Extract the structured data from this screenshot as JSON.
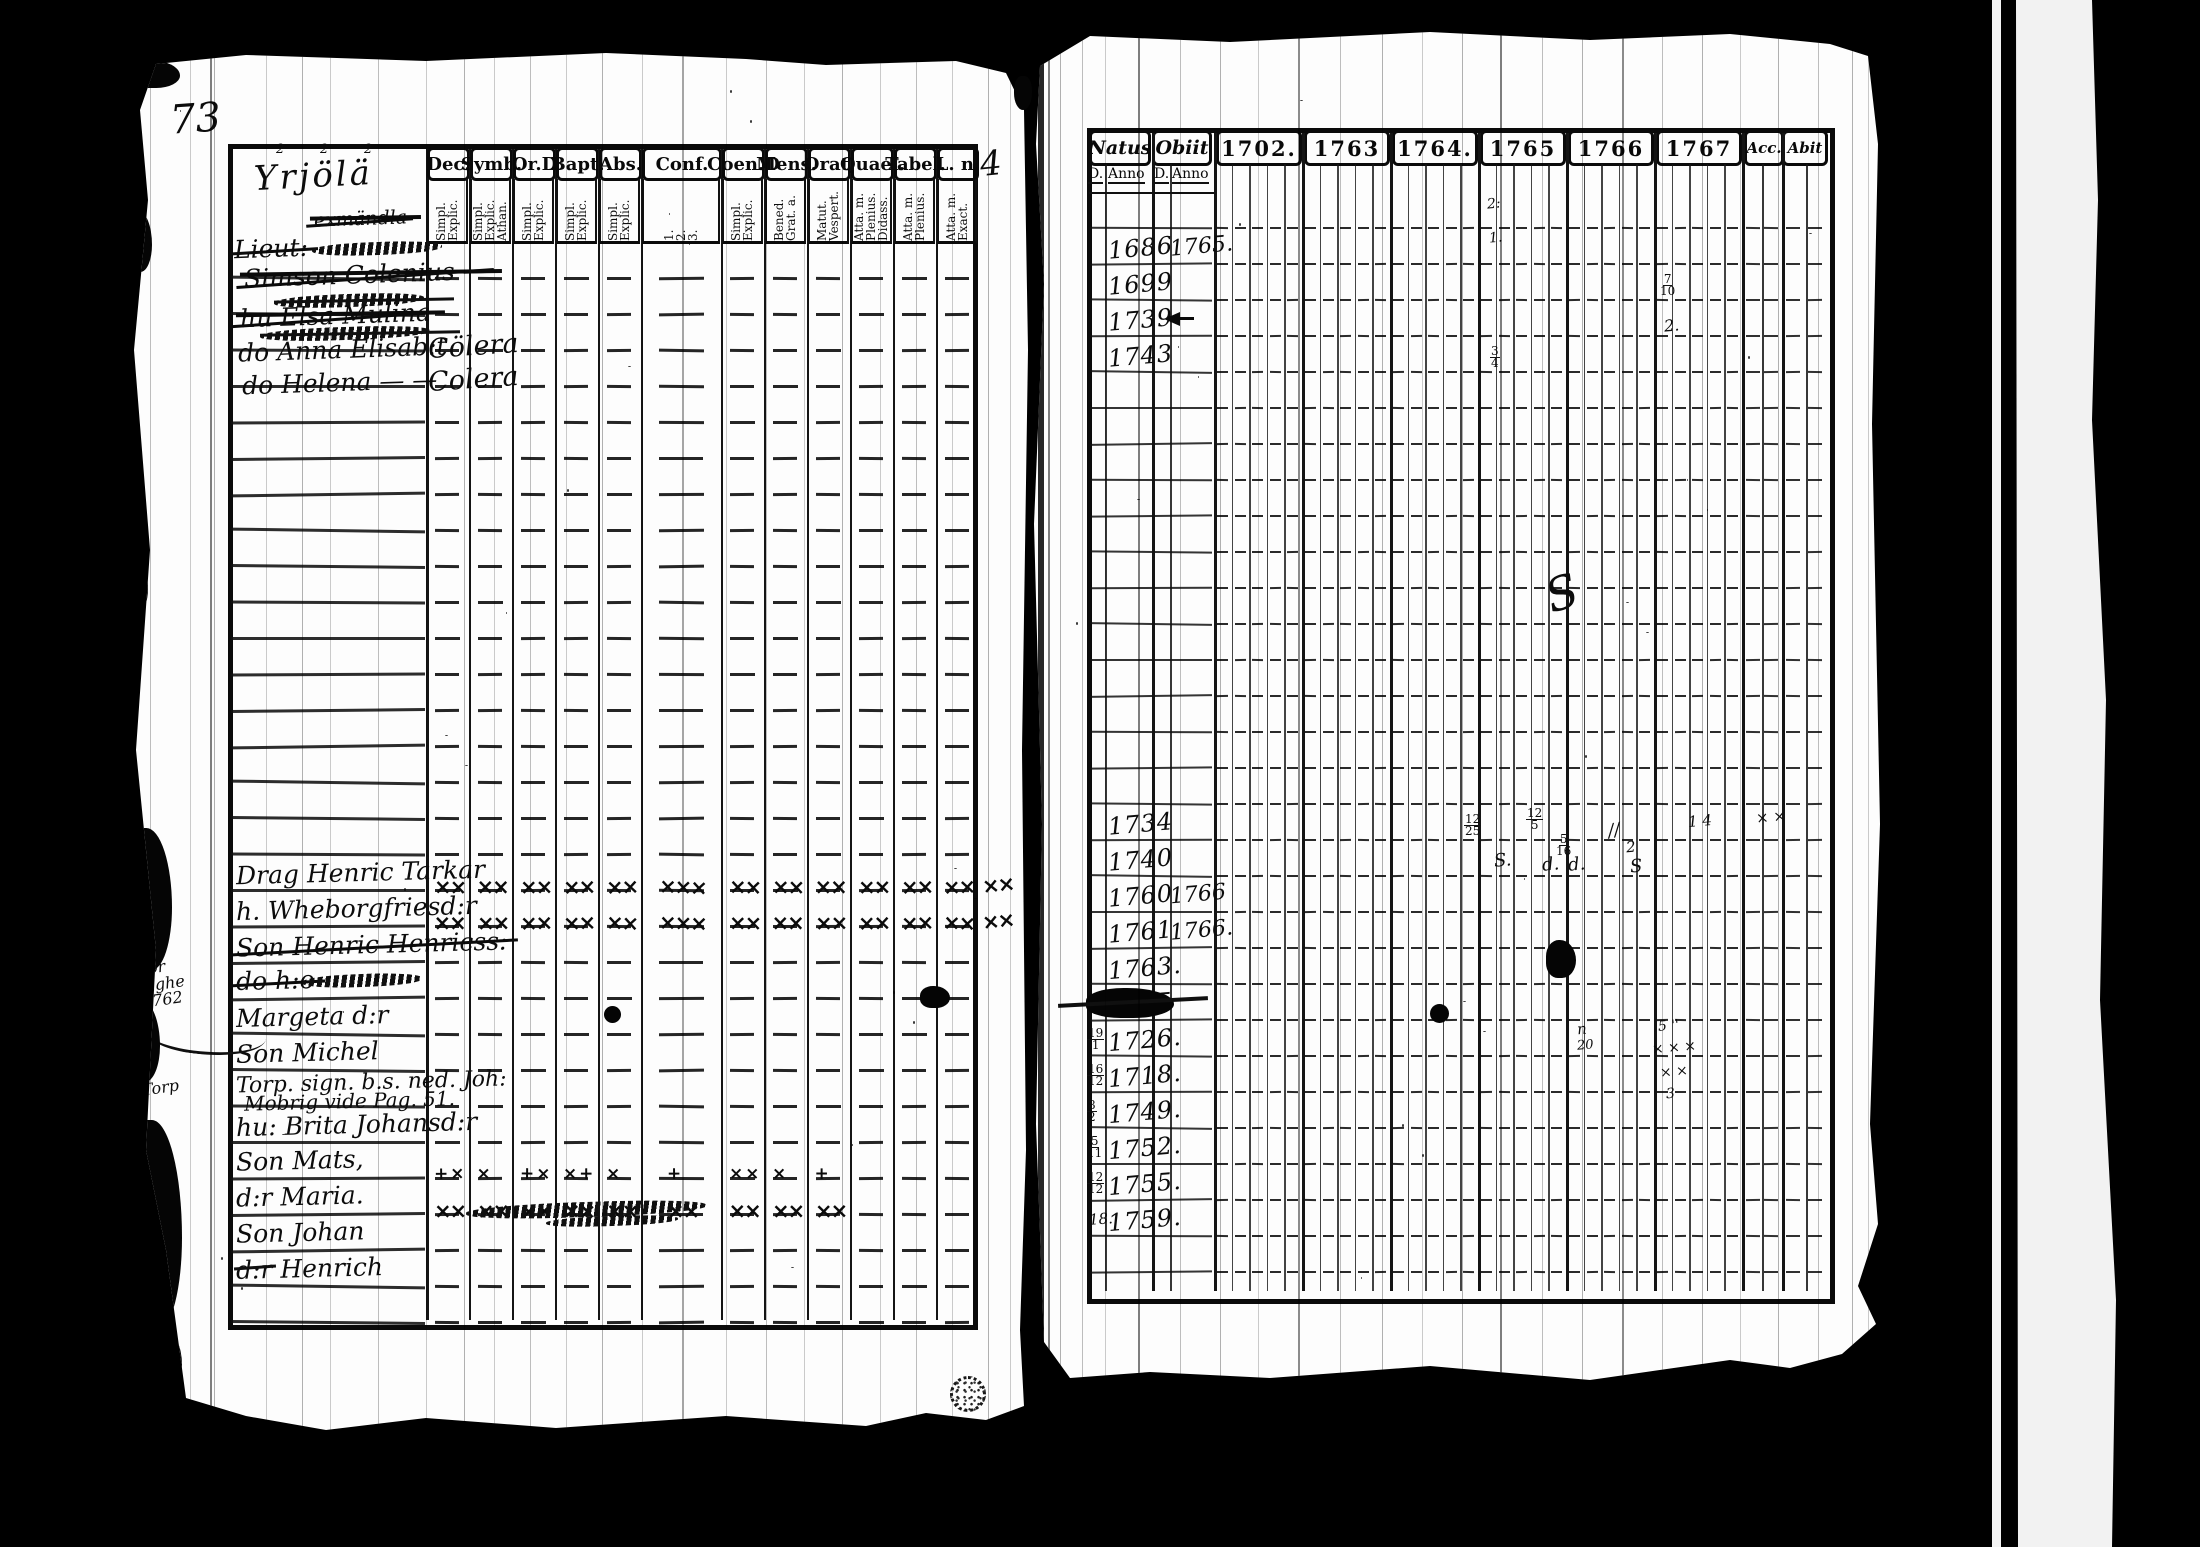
{
  "page_left": {
    "folio": "73",
    "side_note": "4",
    "title": "Yrjölä",
    "title_superscripts": [
      "2",
      "2",
      "2"
    ],
    "columns": [
      {
        "label": "Dec.",
        "sub": [
          "Explic.",
          "Simpl."
        ]
      },
      {
        "label": "Symb.",
        "sub": [
          "Athan.",
          "Explic.",
          "Simpl."
        ]
      },
      {
        "label": "Or.D",
        "sub": [
          "Explic.",
          "Simpl."
        ]
      },
      {
        "label": "Bapt.",
        "sub": [
          "Explic.",
          "Simpl."
        ]
      },
      {
        "label": "Abs.",
        "sub": [
          "Explic.",
          "Simpl."
        ]
      },
      {
        "label": "Conf.",
        "sub": [
          "3.",
          "2.",
          "1."
        ]
      },
      {
        "label": "Coen.D",
        "sub": [
          "Explic.",
          "Simpl."
        ]
      },
      {
        "label": "Mens.",
        "sub": [
          "Grat. a.",
          "Bened."
        ]
      },
      {
        "label": "Orat.",
        "sub": [
          "Vespert.",
          "Matut."
        ]
      },
      {
        "label": "Quael.",
        "sub": [
          "Didass.",
          "Plenius.",
          "Atta. m."
        ]
      },
      {
        "label": "Tabel.",
        "sub": [
          "Plenius.",
          "Atta. m."
        ]
      },
      {
        "label": "L. n.",
        "sub": [
          "Exact.",
          "Atta. m."
        ]
      }
    ],
    "top_entries": [
      {
        "y": 208,
        "text": "exmändla",
        "small": true,
        "struck": true,
        "indent": 84,
        "scrib": 0
      },
      {
        "y": 234,
        "text": "Lieut:",
        "struck": true,
        "indent": 4,
        "scrib": 130
      },
      {
        "y": 260,
        "text": "Simson Colenius —",
        "struck": true,
        "indent": 14,
        "scrib": 0
      },
      {
        "y": 286,
        "text": "",
        "struck": true,
        "indent": 44,
        "scrib": 150
      },
      {
        "y": 301,
        "text": "hu Elsa Mulina",
        "struck": true,
        "indent": 10,
        "scrib": 0
      },
      {
        "y": 319,
        "text": "",
        "struck": true,
        "indent": 30,
        "scrib": 170
      },
      {
        "y": 335,
        "text": "do Anna Elisab:t",
        "indent": 8,
        "scrib": 0,
        "note": "Cölera"
      },
      {
        "y": 368,
        "text": "do Helena — —",
        "indent": 12,
        "scrib": 0,
        "note": "Colera"
      }
    ],
    "rows": [
      {},
      {},
      {},
      {},
      {},
      {},
      {},
      {},
      {},
      {},
      {},
      {},
      {},
      {},
      {},
      {},
      {},
      {
        "name": "Drag Henric Tarkar",
        "x": "full"
      },
      {
        "name": "h. Wheborgfriesd:r",
        "x": "full"
      },
      {
        "name": "Son Henric Henricss:",
        "struck": true
      },
      {
        "name": "do h:o",
        "struck": true,
        "scrib": 120
      },
      {
        "name": "Margeta d:r"
      },
      {
        "name": "Son Michel"
      },
      {
        "name": "Torp. sign. b.s. ned. Joh:",
        "name2": "Mobrig vide Pag. 51."
      },
      {
        "name": "hu: Brita Johansd:r"
      },
      {
        "name": "Son Mats,",
        "x": "light"
      },
      {
        "name": "d:r Maria.",
        "x": "heavy",
        "scrib": 240
      },
      {
        "name": "Son Johan"
      },
      {
        "name": "d:r Henrich",
        "struck_prefix": true
      },
      {}
    ],
    "margins": [
      {
        "lines": [
          "för",
          "righe",
          "1762"
        ],
        "y": 958
      },
      {
        "lines": [
          "Torp"
        ],
        "y": 1078
      }
    ]
  },
  "page_right": {
    "header": {
      "natus": "Natus",
      "obiit": "Obiit",
      "d": "D.",
      "anno": "Anno",
      "years": [
        "1702.",
        "1763",
        "1764.",
        "1765",
        "1766",
        "1767"
      ],
      "acc": "Acc.",
      "abit": "Abit"
    },
    "rows": [
      {},
      {
        "natus": "1686",
        "obiit": "1765."
      },
      {
        "natus": "1699"
      },
      {
        "natus": "1739",
        "arrow": true
      },
      {
        "natus": "1743"
      },
      {},
      {},
      {},
      {},
      {},
      {},
      {},
      {},
      {},
      {},
      {},
      {},
      {
        "natus": "1734"
      },
      {
        "natus": "1740"
      },
      {
        "natus": "1760",
        "obiit": "1766"
      },
      {
        "natus": "1761",
        "obiit": "1766."
      },
      {
        "natus": "1763."
      },
      {
        "natus": "1755",
        "blot": true
      },
      {
        "d": "19/1",
        "natus": "1726."
      },
      {
        "d": "16/12",
        "natus": "1718."
      },
      {
        "d": "8/2",
        "natus": "1749."
      },
      {
        "d": "5/11",
        "natus": "1752."
      },
      {
        "d": "12/12",
        "natus": "1755."
      },
      {
        "d": "18.",
        "natus": "1759."
      },
      {}
    ],
    "marks": [
      {
        "x": 1487,
        "y": 196,
        "t": "2:",
        "s": 14
      },
      {
        "x": 1489,
        "y": 230,
        "t": "1.",
        "s": 14
      },
      {
        "x": 1660,
        "y": 274,
        "t": "7/10",
        "s": 14,
        "fr": true
      },
      {
        "x": 1664,
        "y": 316,
        "t": "2.",
        "s": 16
      },
      {
        "x": 1490,
        "y": 346,
        "t": "3/4",
        "s": 14,
        "fr": true
      },
      {
        "x": 1546,
        "y": 566,
        "t": "S",
        "s": 46,
        "r": -18
      },
      {
        "x": 1464,
        "y": 814,
        "t": "12/25",
        "s": 14,
        "fr": true
      },
      {
        "x": 1526,
        "y": 808,
        "t": "12/5",
        "s": 14,
        "fr": true
      },
      {
        "x": 1556,
        "y": 834,
        "t": "5/16",
        "s": 13,
        "fr": true
      },
      {
        "x": 1608,
        "y": 820,
        "t": "//",
        "s": 18,
        "r": -10
      },
      {
        "x": 1688,
        "y": 812,
        "t": "1 4",
        "s": 15
      },
      {
        "x": 1494,
        "y": 850,
        "t": "S.",
        "s": 18
      },
      {
        "x": 1542,
        "y": 854,
        "t": "d.",
        "s": 18
      },
      {
        "x": 1568,
        "y": 854,
        "t": "d.",
        "s": 18
      },
      {
        "x": 1626,
        "y": 838,
        "t": "2",
        "s": 15
      },
      {
        "x": 1630,
        "y": 856,
        "t": "S",
        "s": 18
      },
      {
        "x": 1756,
        "y": 808,
        "t": "× ×",
        "s": 15
      },
      {
        "x": 1577,
        "y": 1020,
        "t": "n",
        "s": 15
      },
      {
        "x": 1577,
        "y": 1038,
        "t": "20",
        "s": 13
      },
      {
        "x": 1658,
        "y": 1018,
        "t": "5 ''",
        "s": 14
      },
      {
        "x": 1652,
        "y": 1040,
        "t": "× × ×",
        "s": 14
      },
      {
        "x": 1660,
        "y": 1064,
        "t": "× ×",
        "s": 14
      },
      {
        "x": 1666,
        "y": 1086,
        "t": "3",
        "s": 14
      }
    ]
  }
}
